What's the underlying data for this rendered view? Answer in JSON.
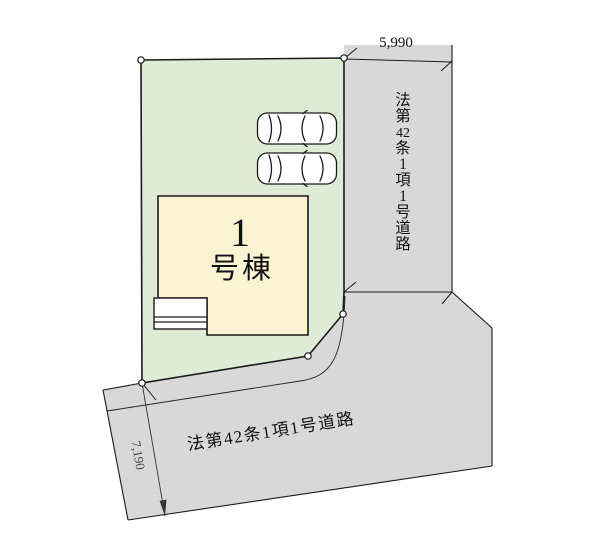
{
  "plan": {
    "type": "site-plan"
  },
  "dimensions": {
    "top": "5,990",
    "left": "7,190"
  },
  "right_road": {
    "label": "法第42条1項1号道路",
    "chars": [
      "法",
      "第",
      "42",
      "条",
      "1",
      "項",
      "1",
      "号",
      "道",
      "路"
    ]
  },
  "bottom_road": {
    "label": "法第42条1項1号道路"
  },
  "building": {
    "number": "1",
    "suffix": "号棟"
  },
  "icons": {
    "car": "car-top-view-icon",
    "corner_marker": "survey-point-circle-icon"
  },
  "colors": {
    "lot": "#dfebd4",
    "road": "#d8d8d8",
    "building": "#fcf3d2",
    "outline": "#1a1a1a",
    "text": "#111111"
  }
}
